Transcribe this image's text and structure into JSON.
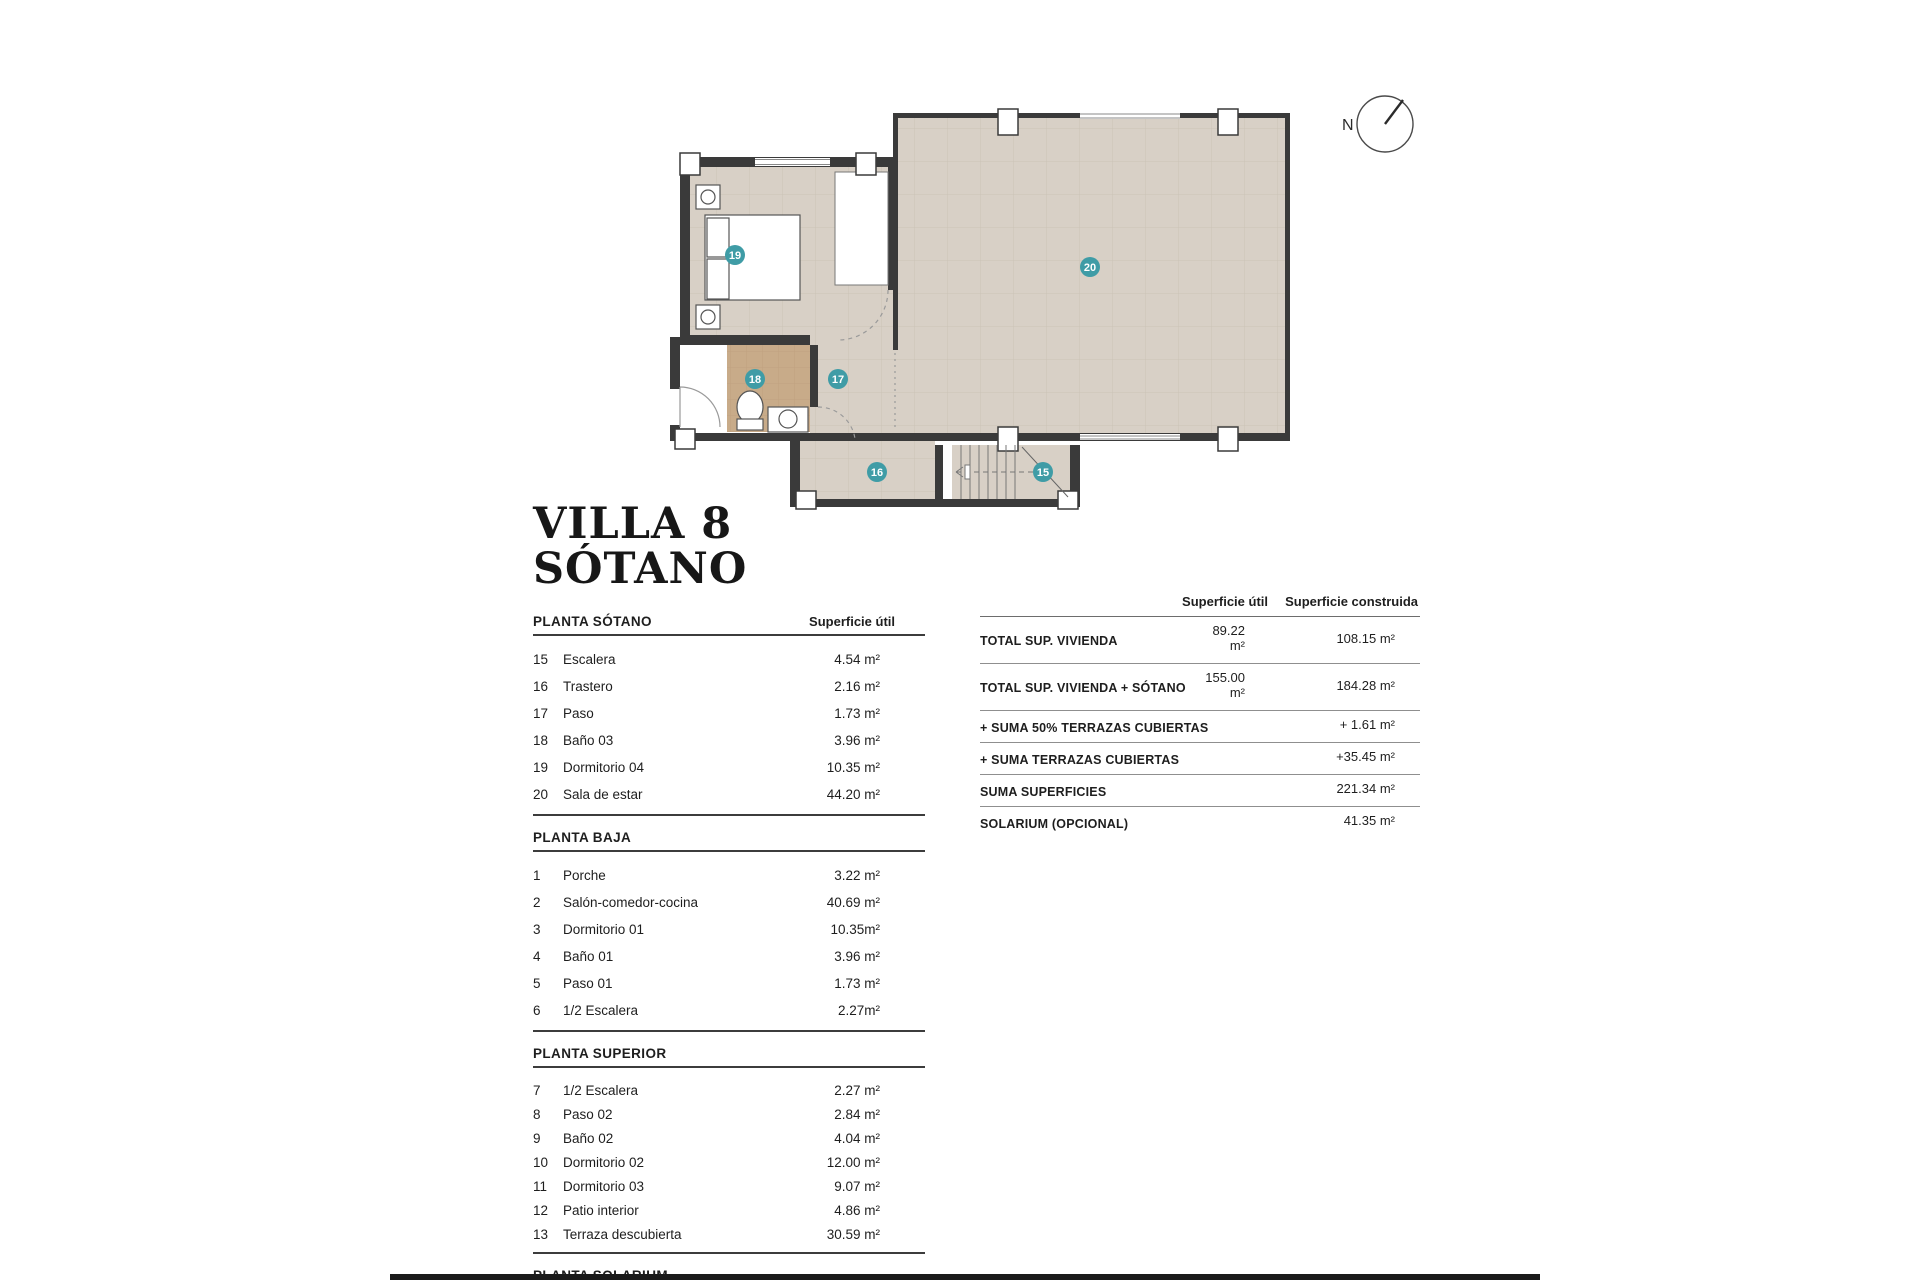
{
  "title": {
    "line1": "VILLA 8",
    "line2": "SÓTANO"
  },
  "compass": {
    "north_label": "N"
  },
  "plan": {
    "badges": {
      "b15": "15",
      "b16": "16",
      "b17": "17",
      "b18": "18",
      "b19": "19",
      "b20": "20"
    },
    "colors": {
      "floor": "#d8d0c6",
      "tile_line": "#cbc3b7",
      "bath_floor": "#c8ab89",
      "wall": "#3a3a3a",
      "badge": "#3f9ca6"
    }
  },
  "sections": [
    {
      "title": "PLANTA SÓTANO",
      "col_header": "Superficie útil",
      "rows": [
        [
          "15",
          "Escalera",
          "4.54 m²"
        ],
        [
          "16",
          "Trastero",
          "2.16 m²"
        ],
        [
          "17",
          "Paso",
          "1.73 m²"
        ],
        [
          "18",
          "Baño 03",
          "3.96 m²"
        ],
        [
          "19",
          "Dormitorio 04",
          "10.35 m²"
        ],
        [
          "20",
          "Sala de estar",
          "44.20 m²"
        ]
      ]
    },
    {
      "title": "PLANTA BAJA",
      "col_header": "",
      "rows": [
        [
          "1",
          "Porche",
          "3.22 m²"
        ],
        [
          "2",
          "Salón-comedor-cocina",
          "40.69 m²"
        ],
        [
          "3",
          "Dormitorio 01",
          "10.35m²"
        ],
        [
          "4",
          "Baño 01",
          "3.96 m²"
        ],
        [
          "5",
          "Paso 01",
          "1.73 m²"
        ],
        [
          "6",
          "1/2 Escalera",
          "2.27m²"
        ]
      ]
    },
    {
      "title": "PLANTA SUPERIOR",
      "col_header": "",
      "rows": [
        [
          "7",
          "1/2 Escalera",
          "2.27 m²"
        ],
        [
          "8",
          "Paso 02",
          "2.84 m²"
        ],
        [
          "9",
          "Baño 02",
          "4.04 m²"
        ],
        [
          "10",
          "Dormitorio 02",
          "12.00 m²"
        ],
        [
          "11",
          "Dormitorio 03",
          "9.07 m²"
        ],
        [
          "12",
          "Patio interior",
          "4.86 m²"
        ],
        [
          "13",
          "Terraza descubierta",
          "30.59 m²"
        ]
      ]
    },
    {
      "title": "PLANTA SOLARIUM",
      "col_header": "",
      "rows": [
        [
          "14",
          "SOLARIUM",
          "41.35 m²"
        ]
      ]
    }
  ],
  "summary": {
    "col1_header": "Superficie útil",
    "col2_header": "Superficie construida",
    "rows": [
      {
        "label": "TOTAL SUP. VIVIENDA",
        "util": "89.22 m²",
        "constr": "108.15 m²"
      },
      {
        "label": "TOTAL SUP. VIVIENDA + SÓTANO",
        "util": "155.00  m²",
        "constr": "184.28 m²"
      },
      {
        "label": "+ SUMA 50% TERRAZAS CUBIERTAS",
        "util": "",
        "constr": "+ 1.61 m²"
      },
      {
        "label": "+ SUMA TERRAZAS CUBIERTAS",
        "util": "",
        "constr": "+35.45 m²"
      },
      {
        "label": "SUMA SUPERFICIES",
        "util": "",
        "constr": "221.34 m²"
      },
      {
        "label": "SOLARIUM (OPCIONAL)",
        "util": "",
        "constr": "41.35 m²"
      }
    ]
  }
}
